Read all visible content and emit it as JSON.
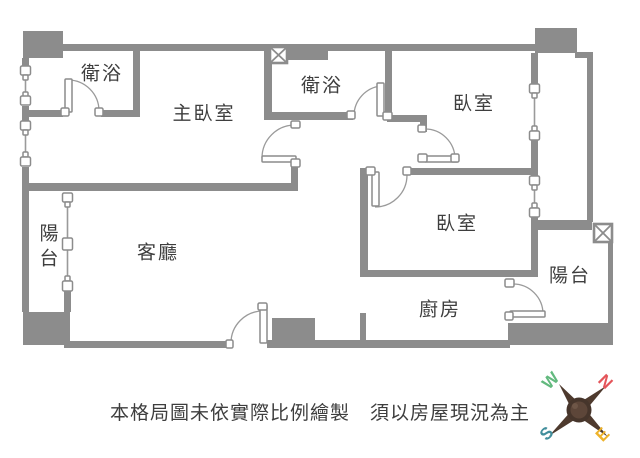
{
  "rooms": {
    "bathroom_top_left": "衛浴",
    "master_bedroom": "主臥室",
    "bathroom_middle": "衛浴",
    "bedroom_top_right": "臥室",
    "bedroom_middle_right": "臥室",
    "balcony_left": "陽台",
    "living_room": "客廳",
    "kitchen": "廚房",
    "balcony_right": "陽台"
  },
  "disclaimer": "本格局圖未依實際比例繪製　須以房屋現況為主",
  "compass": {
    "west": "W",
    "north": "N",
    "south": "S",
    "east": "E"
  },
  "colors": {
    "wall": "#8c8c8c",
    "line": "#9a9a9a",
    "text": "#3e3e3e",
    "compass_west": "#62b97e",
    "compass_north": "#e4555a",
    "compass_south": "#418e9c",
    "compass_east": "#eeb32a",
    "compass_body": "#4e3a2e"
  }
}
